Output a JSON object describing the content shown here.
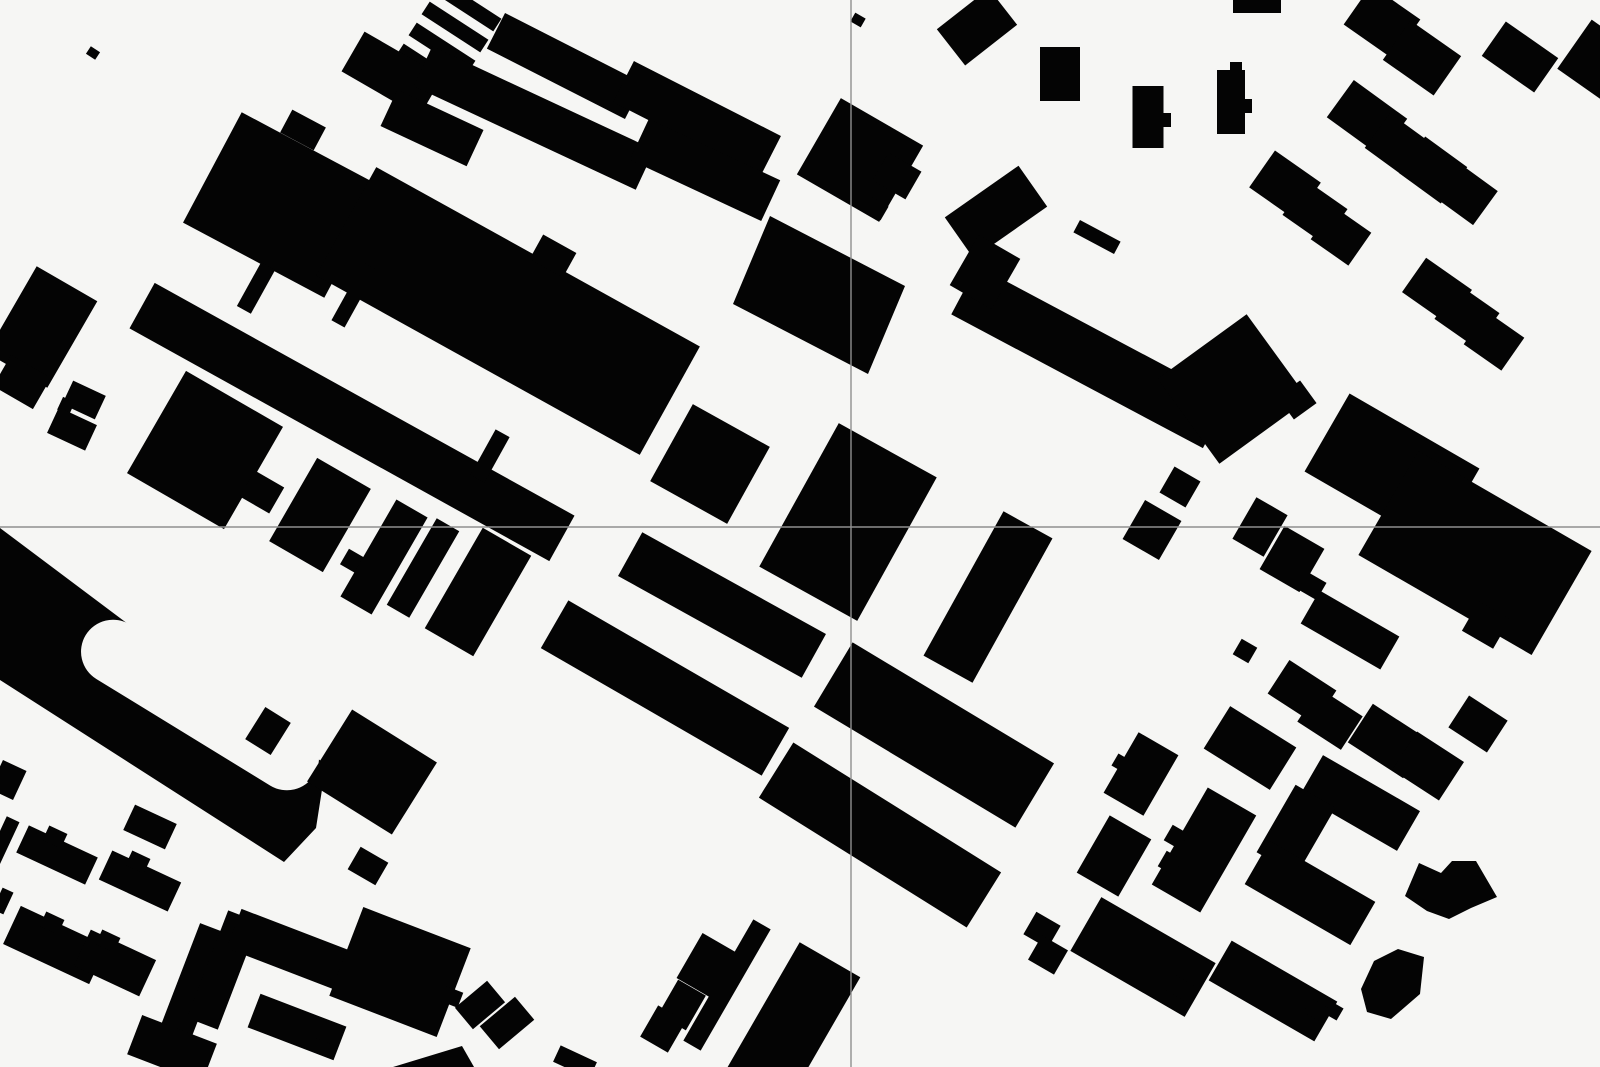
{
  "map": {
    "canvas": {
      "width": 1600,
      "height": 1067
    },
    "background_color": "#f6f6f4",
    "building_color": "#040404",
    "crosshair": {
      "x": 851,
      "y": 527,
      "color": "#8f8f8f",
      "stroke_width": 1.4,
      "opacity": 1
    },
    "stadium": {
      "outer_points": "0,528 256,720 326,764 316,828 284,862 0,680",
      "courtyard": {
        "cx": 200,
        "cy": 705,
        "w": 268,
        "h": 64,
        "rx": 32,
        "r": 31.5
      },
      "inner_rect": [
        268,
        731,
        30,
        38,
        32
      ]
    },
    "buildings": [
      [
        93,
        53,
        11,
        9,
        33
      ],
      [
        283,
        205,
        160,
        125,
        28
      ],
      [
        303,
        130,
        38,
        26,
        28
      ],
      [
        42,
        327,
        70,
        100,
        30
      ],
      [
        22,
        382,
        46,
        36,
        30
      ],
      [
        84,
        400,
        36,
        26,
        25
      ],
      [
        66,
        406,
        13,
        14,
        25
      ],
      [
        72,
        429,
        42,
        28,
        25
      ],
      [
        468,
        6,
        70,
        15,
        33
      ],
      [
        455,
        27,
        70,
        15,
        33
      ],
      [
        442,
        48,
        70,
        15,
        33
      ],
      [
        429,
        69,
        70,
        15,
        33
      ],
      [
        392,
        74,
        90,
        46,
        30
      ],
      [
        432,
        128,
        95,
        40,
        25
      ],
      [
        565,
        66,
        155,
        40,
        27
      ],
      [
        697,
        119,
        165,
        46,
        27
      ],
      [
        534,
        118,
        245,
        44,
        25
      ],
      [
        705,
        170,
        145,
        45,
        25
      ],
      [
        508,
        311,
        370,
        124,
        29
      ],
      [
        553,
        256,
        38,
        28,
        29
      ],
      [
        352,
        422,
        480,
        52,
        29
      ],
      [
        256,
        288,
        16,
        50,
        29
      ],
      [
        354,
        295,
        15,
        66,
        29
      ],
      [
        490,
        456,
        16,
        52,
        29
      ],
      [
        205,
        450,
        112,
        118,
        30
      ],
      [
        262,
        492,
        34,
        30,
        30
      ],
      [
        320,
        515,
        62,
        96,
        30
      ],
      [
        354,
        562,
        22,
        18,
        30
      ],
      [
        384,
        557,
        36,
        112,
        30
      ],
      [
        423,
        568,
        26,
        100,
        30
      ],
      [
        478,
        592,
        56,
        116,
        30
      ],
      [
        372,
        772,
        100,
        85,
        32
      ],
      [
        710,
        464,
        88,
        88,
        29
      ],
      [
        848,
        522,
        112,
        164,
        29
      ],
      [
        722,
        605,
        210,
        50,
        29
      ],
      [
        665,
        688,
        255,
        55,
        30
      ],
      [
        988,
        597,
        56,
        165,
        29
      ],
      [
        934,
        735,
        235,
        75,
        31
      ],
      [
        880,
        835,
        245,
        65,
        32
      ],
      [
        727,
        985,
        20,
        140,
        30
      ],
      [
        706,
        965,
        38,
        52,
        30
      ],
      [
        682,
        1005,
        32,
        40,
        30
      ],
      [
        663,
        1029,
        32,
        36,
        30
      ],
      [
        790,
        1029,
        70,
        160,
        30
      ],
      [
        480,
        1005,
        42,
        28,
        -40
      ],
      [
        507,
        1023,
        46,
        30,
        -40
      ],
      [
        150,
        827,
        46,
        28,
        25
      ],
      [
        57,
        855,
        76,
        30,
        25
      ],
      [
        55,
        837,
        20,
        16,
        25
      ],
      [
        140,
        881,
        76,
        32,
        25
      ],
      [
        138,
        862,
        20,
        16,
        25
      ],
      [
        55,
        945,
        95,
        42,
        25
      ],
      [
        52,
        923,
        20,
        16,
        25
      ],
      [
        115,
        963,
        72,
        40,
        25
      ],
      [
        108,
        941,
        20,
        16,
        25
      ],
      [
        8,
        780,
        26,
        32,
        25
      ],
      [
        3,
        841,
        14,
        48,
        25
      ],
      [
        3,
        901,
        12,
        24,
        25
      ],
      [
        368,
        866,
        32,
        26,
        30
      ],
      [
        194,
        985,
        33,
        120,
        21
      ],
      [
        223,
        970,
        33,
        115,
        21
      ],
      [
        290,
        950,
        120,
        42,
        21
      ],
      [
        400,
        972,
        115,
        95,
        21
      ],
      [
        452,
        997,
        18,
        16,
        21
      ],
      [
        297,
        1027,
        92,
        36,
        21
      ],
      [
        322,
        1048,
        18,
        14,
        21
      ],
      [
        172,
        1049,
        80,
        42,
        21
      ],
      [
        575,
        1062,
        40,
        18,
        25
      ],
      [
        1141,
        774,
        46,
        70,
        30
      ],
      [
        1121,
        763,
        14,
        14,
        30
      ],
      [
        1250,
        748,
        78,
        50,
        32
      ],
      [
        1302,
        692,
        56,
        40,
        33
      ],
      [
        1330,
        719,
        52,
        40,
        33
      ],
      [
        1388,
        741,
        66,
        46,
        33
      ],
      [
        1428,
        766,
        56,
        46,
        33
      ],
      [
        1478,
        724,
        46,
        38,
        33
      ],
      [
        1114,
        856,
        48,
        66,
        30
      ],
      [
        1204,
        850,
        56,
        112,
        30
      ],
      [
        1176,
        837,
        18,
        18,
        30
      ],
      [
        1170,
        863,
        18,
        18,
        30
      ],
      [
        1360,
        803,
        112,
        46,
        30
      ],
      [
        1296,
        830,
        46,
        78,
        30
      ],
      [
        1310,
        893,
        122,
        50,
        30
      ],
      [
        1143,
        957,
        132,
        62,
        30
      ],
      [
        1180,
        988,
        22,
        18,
        30
      ],
      [
        1273,
        991,
        122,
        46,
        30
      ],
      [
        1316,
        1010,
        20,
        16,
        30
      ],
      [
        1334,
        1011,
        14,
        14,
        30
      ],
      [
        1245,
        651,
        18,
        18,
        30
      ],
      [
        1090,
        357,
        285,
        55,
        28
      ],
      [
        996,
        212,
        90,
        50,
        -35
      ],
      [
        985,
        272,
        48,
        58,
        30
      ],
      [
        1233,
        389,
        110,
        105,
        -36
      ],
      [
        1297,
        400,
        28,
        28,
        -36
      ],
      [
        1180,
        487,
        30,
        30,
        30
      ],
      [
        1152,
        530,
        42,
        45,
        30
      ],
      [
        1260,
        527,
        36,
        48,
        30
      ],
      [
        1292,
        559,
        46,
        50,
        30
      ],
      [
        1312,
        586,
        22,
        20,
        30
      ],
      [
        1392,
        470,
        150,
        90,
        30
      ],
      [
        1475,
        553,
        200,
        120,
        30
      ],
      [
        1486,
        625,
        36,
        34,
        30
      ],
      [
        1350,
        630,
        92,
        38,
        30
      ],
      [
        858,
        20,
        12,
        10,
        30
      ],
      [
        977,
        27,
        66,
        46,
        -38
      ],
      [
        1060,
        74,
        40,
        54,
        0
      ],
      [
        1148,
        117,
        31,
        62,
        0
      ],
      [
        1166,
        120,
        10,
        14,
        0
      ],
      [
        1231,
        102,
        28,
        64,
        0
      ],
      [
        1247,
        106,
        10,
        14,
        0
      ],
      [
        1236,
        67,
        12,
        10,
        0
      ],
      [
        1257,
        6,
        48,
        14,
        0
      ],
      [
        1382,
        22,
        60,
        48,
        35
      ],
      [
        1422,
        58,
        62,
        48,
        35
      ],
      [
        1520,
        57,
        64,
        42,
        35
      ],
      [
        1597,
        60,
        55,
        60,
        35
      ],
      [
        1367,
        118,
        66,
        46,
        36
      ],
      [
        1400,
        147,
        56,
        43,
        36
      ],
      [
        1433,
        170,
        52,
        45,
        36
      ],
      [
        1466,
        194,
        48,
        42,
        36
      ],
      [
        1285,
        185,
        56,
        45,
        35
      ],
      [
        1315,
        212,
        50,
        42,
        35
      ],
      [
        1341,
        236,
        46,
        40,
        35
      ],
      [
        1437,
        291,
        56,
        42,
        35
      ],
      [
        1467,
        316,
        50,
        42,
        35
      ],
      [
        1494,
        341,
        46,
        40,
        35
      ],
      [
        1097,
        237,
        46,
        14,
        28
      ],
      [
        860,
        160,
        95,
        88,
        30
      ],
      [
        897,
        176,
        38,
        32,
        30
      ],
      [
        875,
        208,
        22,
        16,
        30
      ],
      [
        1042,
        930,
        28,
        26,
        30
      ],
      [
        1048,
        955,
        30,
        28,
        30
      ]
    ],
    "polygons": [
      {
        "points": "770,216 905,286 868,374 733,304"
      },
      {
        "points": "393,1067 462,1046 474,1067"
      },
      {
        "points": "1405,896 1419,863 1441,873 1452,861 1476,861 1497,897 1471,908 1449,919 1427,911"
      },
      {
        "points": "1361,989 1374,961 1398,949 1424,957 1420,994 1391,1019 1367,1012"
      }
    ]
  }
}
